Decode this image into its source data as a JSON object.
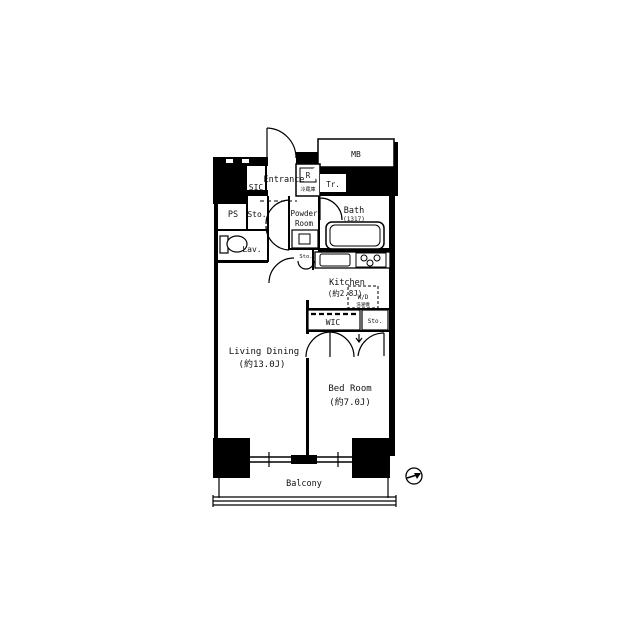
{
  "plan": {
    "type": "apartment-floor-plan",
    "rooms": {
      "entrance": "Entrance",
      "sic": "SIC",
      "ps": "PS",
      "storage": "Sto.",
      "lavatory": "Lav.",
      "powder_line1": "Powder",
      "powder_line2": "Room",
      "bath": "Bath",
      "bath_size": "(1317)",
      "refrigerator_box": "R",
      "refrigerator_sub": "冷蔵庫",
      "meter_box": "MB",
      "trunk": "Tr.",
      "kitchen": "Kitchen",
      "kitchen_size": "(約2.8J)",
      "washer_dryer": "W/D",
      "washer_dryer_sub": "洗濯機",
      "wic": "WIC",
      "storage_small": "Sto.",
      "storage_wic": "Sto.",
      "living_dining": "Living Dining",
      "living_dining_size": "(約13.0J)",
      "bedroom": "Bed Room",
      "bedroom_size": "(約7.0J)",
      "balcony": "Balcony"
    },
    "colors": {
      "wall": "#000000",
      "floor": "#ffffff"
    }
  }
}
